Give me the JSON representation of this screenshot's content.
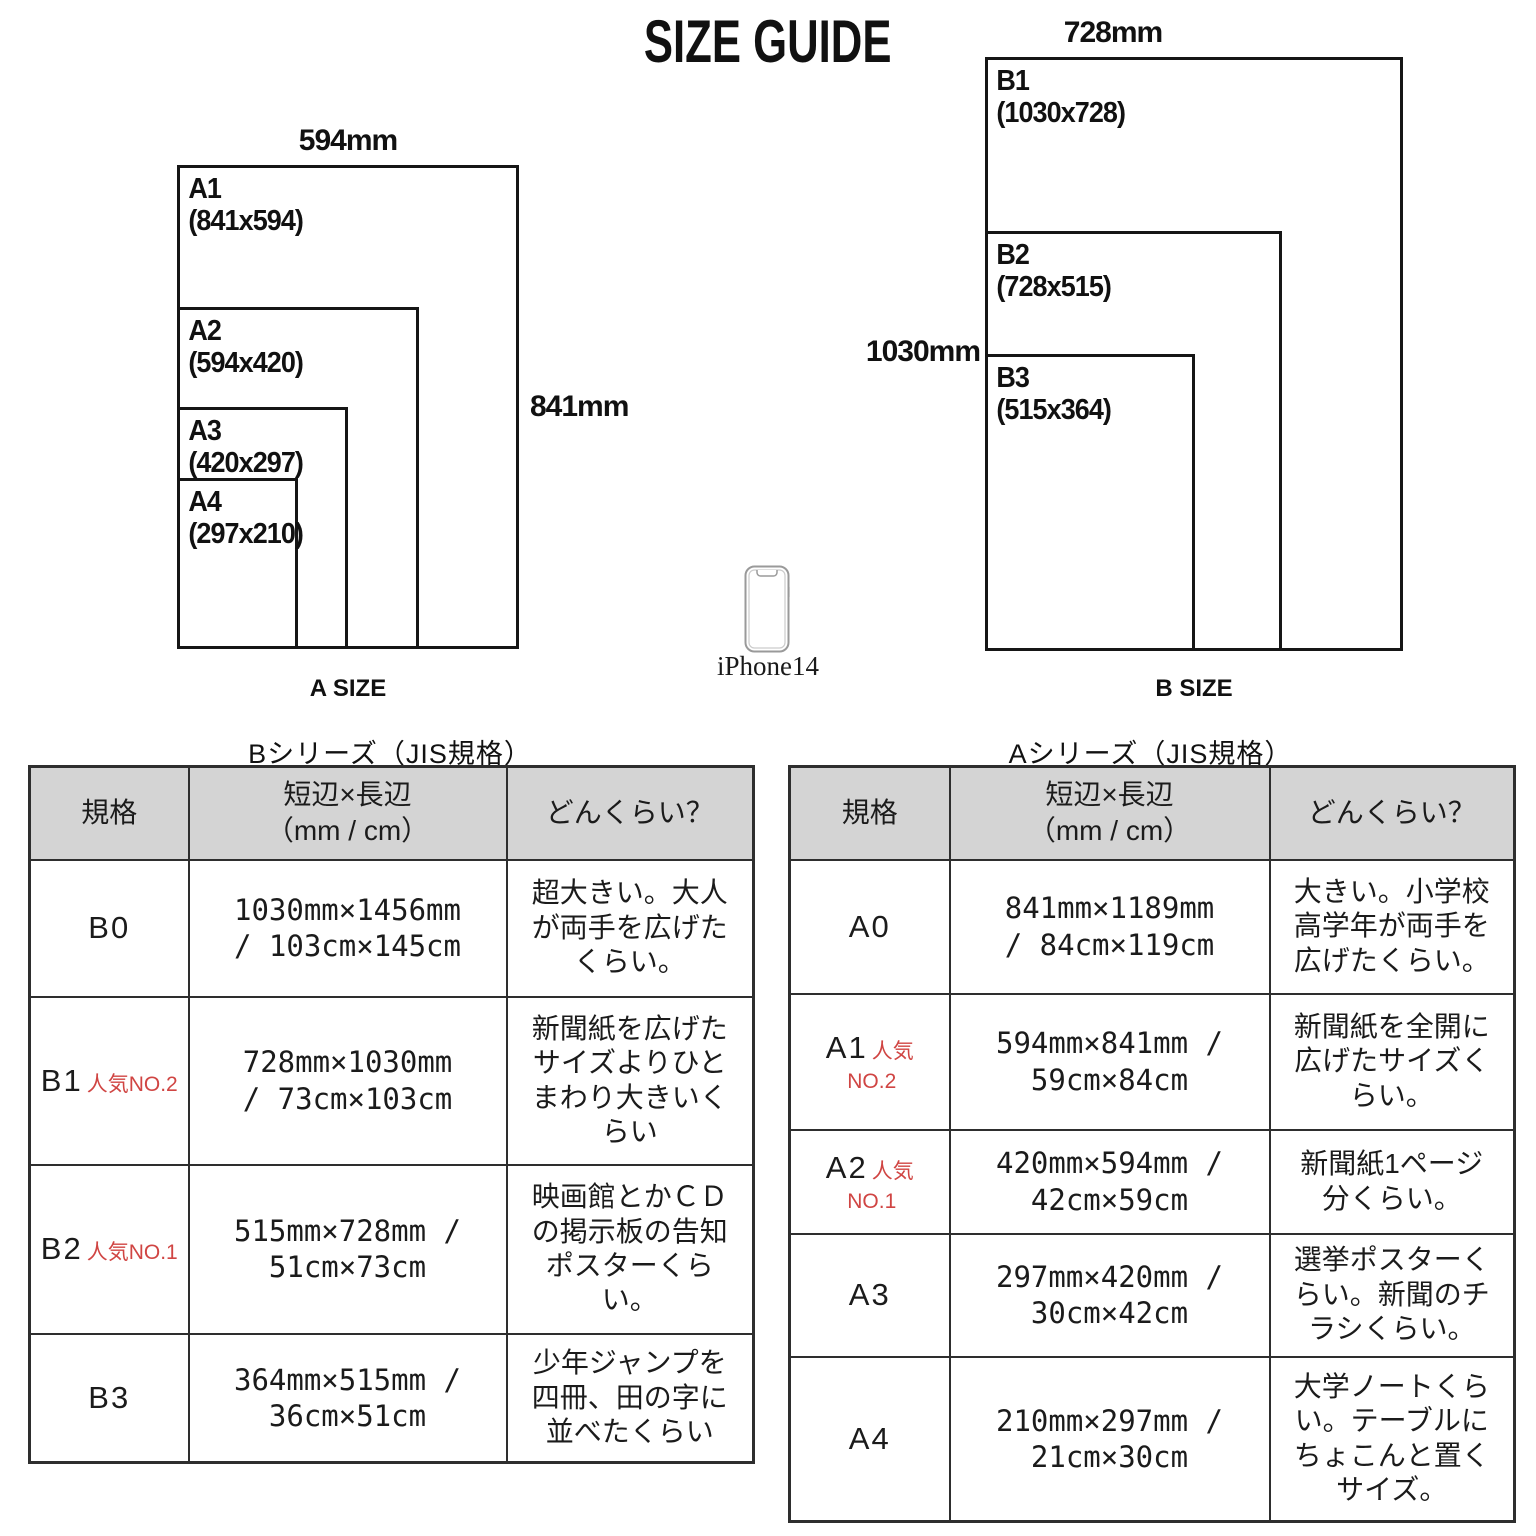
{
  "title": "SIZE GUIDE",
  "diagrams": {
    "a": {
      "top_label": "594mm",
      "side_label": "841mm",
      "caption": "A SIZE",
      "sheets": [
        {
          "name": "A1",
          "dims": "(841x594)"
        },
        {
          "name": "A2",
          "dims": "(594x420)"
        },
        {
          "name": "A3",
          "dims": "(420x297)"
        },
        {
          "name": "A4",
          "dims": "(297x210)"
        }
      ]
    },
    "b": {
      "top_label": "728mm",
      "side_label": "1030mm",
      "caption": "B SIZE",
      "sheets": [
        {
          "name": "B1",
          "dims": "(1030x728)"
        },
        {
          "name": "B2",
          "dims": "(728x515)"
        },
        {
          "name": "B3",
          "dims": "(515x364)"
        }
      ]
    }
  },
  "phone": {
    "label": "iPhone14"
  },
  "tables": {
    "b_series": {
      "title": "Bシリーズ（JIS規格）",
      "headers": {
        "std": "規格",
        "dims": "短辺×長辺\n（mm / cm）",
        "desc": "どんくらい？"
      },
      "rows": [
        {
          "std": "B0",
          "pop": "",
          "pop2": "",
          "dims": "1030mm×1456mm\n/ 103cm×145cm",
          "desc": "超大きい。大人\nが両手を広げた\nくらい。"
        },
        {
          "std": "B1",
          "pop": "人気NO.2",
          "pop2": "",
          "dims": "728mm×1030mm\n/ 73cm×103cm",
          "desc": "新聞紙を広げた\nサイズよりひと\nまわり大きいく\nらい"
        },
        {
          "std": "B2",
          "pop": "人気NO.1",
          "pop2": "",
          "dims": "515mm×728mm /\n51cm×73cm",
          "desc": "映画館とかＣＤ\nの掲示板の告知\nポスターくら\nい。"
        },
        {
          "std": "B3",
          "pop": "",
          "pop2": "",
          "dims": "364mm×515mm /\n36cm×51cm",
          "desc": "少年ジャンプを\n四冊、田の字に\n並べたくらい"
        }
      ]
    },
    "a_series": {
      "title": "Aシリーズ（JIS規格）",
      "headers": {
        "std": "規格",
        "dims": "短辺×長辺\n（mm / cm）",
        "desc": "どんくらい？"
      },
      "rows": [
        {
          "std": "A0",
          "pop": "",
          "pop2": "",
          "dims": "841mm×1189mm\n/ 84cm×119cm",
          "desc": "大きい。小学校\n高学年が両手を\n広げたくらい。"
        },
        {
          "std": "A1",
          "pop": "人気",
          "pop2": "NO.2",
          "dims": "594mm×841mm /\n59cm×84cm",
          "desc": "新聞紙を全開に\n広げたサイズく\nらい。"
        },
        {
          "std": "A2",
          "pop": "人気",
          "pop2": "NO.1",
          "dims": "420mm×594mm /\n42cm×59cm",
          "desc": "新聞紙1ページ\n分くらい。"
        },
        {
          "std": "A3",
          "pop": "",
          "pop2": "",
          "dims": "297mm×420mm /\n30cm×42cm",
          "desc": "選挙ポスターく\nらい。新聞のチ\nラシくらい。"
        },
        {
          "std": "A4",
          "pop": "",
          "pop2": "",
          "dims": "210mm×297mm /\n21cm×30cm",
          "desc": "大学ノートくら\nい。テーブルに\nちょこんと置く\nサイズ。"
        }
      ]
    }
  },
  "colors": {
    "accent_red": "#d04543",
    "header_bg": "#d4d4d4",
    "line": "#2e2e2e",
    "phone_stroke": "#9a9a9a"
  }
}
